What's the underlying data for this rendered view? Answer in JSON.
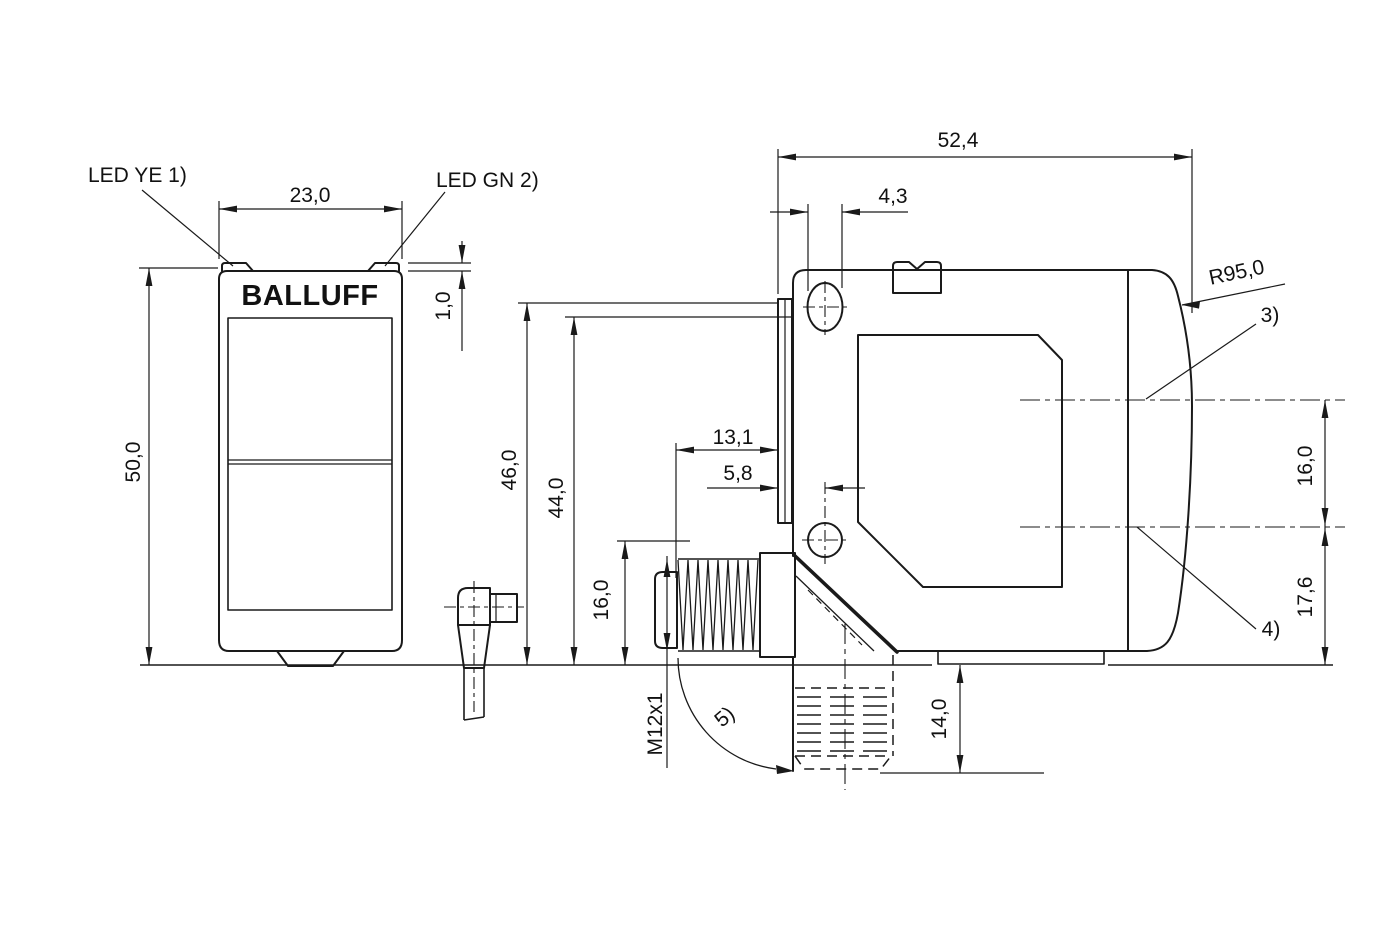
{
  "labels": {
    "brand_logo": "BALLUFF",
    "led_yellow": "LED YE 1)",
    "led_green": "LED GN 2)"
  },
  "front_view": {
    "dim_width": "23,0",
    "dim_height": "50,0",
    "dim_led_lip": "1,0"
  },
  "side_view": {
    "dim_total_depth": "52,4",
    "dim_slot_width": "4,3",
    "radius_front": "R95,0",
    "dim_connector_to_front": "13,1",
    "dim_front_to_hole_center": "5,8",
    "dim_height_46": "46,0",
    "dim_height_44": "44,0",
    "dim_connector_top": "16,0",
    "thread_label": "M12x1",
    "dim_connector_down": "14,0",
    "dim_axis_gap": "16,0",
    "dim_axis_to_base": "17,6",
    "note_3": "3)",
    "note_4": "4)",
    "note_5": "5)"
  }
}
